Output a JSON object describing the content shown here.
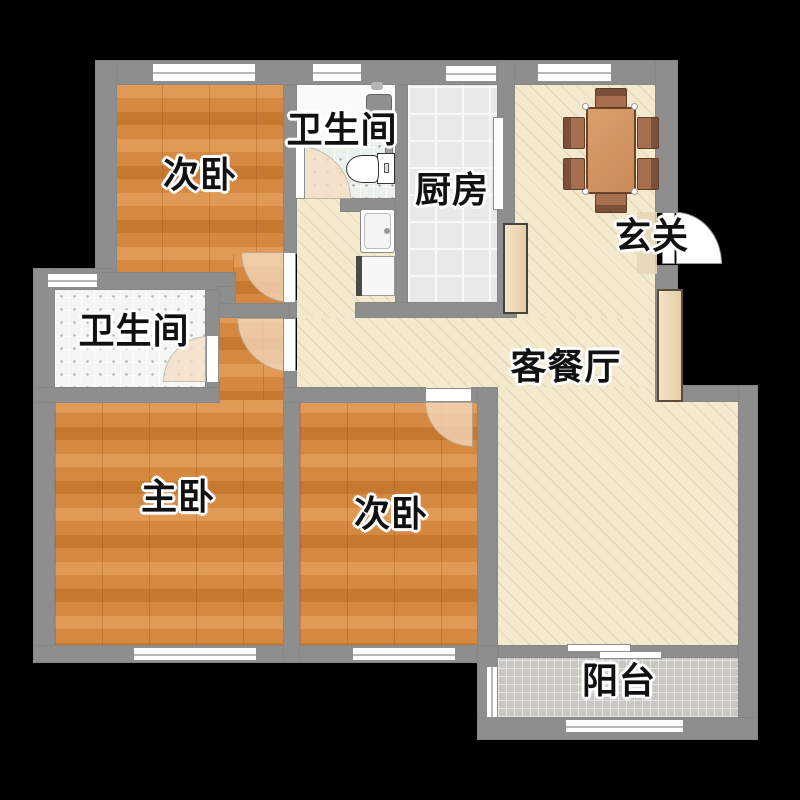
{
  "rooms": [
    {
      "id": "bedroom-top",
      "label": "次卧"
    },
    {
      "id": "bathroom-top",
      "label": "卫生间"
    },
    {
      "id": "kitchen",
      "label": "厨房"
    },
    {
      "id": "entry",
      "label": "玄关"
    },
    {
      "id": "living-dining",
      "label": "客餐厅"
    },
    {
      "id": "bathroom-left",
      "label": "卫生间"
    },
    {
      "id": "master-bedroom",
      "label": "主卧"
    },
    {
      "id": "bedroom-bottom",
      "label": "次卧"
    },
    {
      "id": "balcony",
      "label": "阳台"
    }
  ],
  "colors": {
    "background": "#000000",
    "wall": "#8e8e8e",
    "wood": "#d5883f",
    "wood_light": "#e19a55",
    "wood_dark": "#c7782f",
    "cream": "#f3e9cd",
    "hatch": "#b4a1794d",
    "kitchen_tile": "#e9e9e9",
    "bath_tile": "#eaf0ea",
    "bath_tile_left": "#f3f6f2",
    "balcony_tile": "#c9c7c1",
    "door_swing": "#f6ddc2",
    "table": "#c98a59",
    "table_border": "#6e4226",
    "chair": "#a86f4e",
    "chair_back": "#7c4f39",
    "cabinet": "#e6cda6",
    "label": "#111111"
  }
}
